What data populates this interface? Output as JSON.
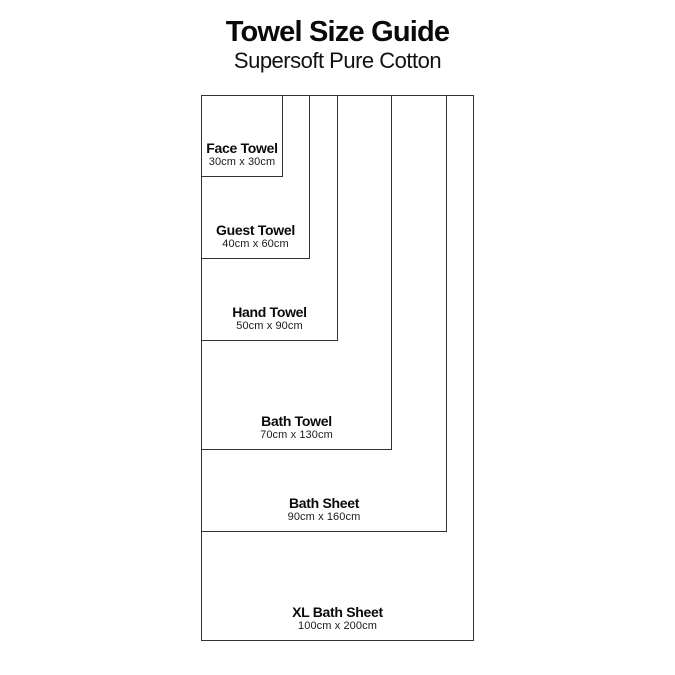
{
  "header": {
    "title": "Towel Size Guide",
    "subtitle": "Supersoft Pure Cotton"
  },
  "diagram": {
    "unit": "cm",
    "line_color": "#333333",
    "pixels_per_cm": 2.73,
    "towels": [
      {
        "name": "Face Towel",
        "dims_label": "30cm x 30cm",
        "width_cm": 30,
        "height_cm": 30
      },
      {
        "name": "Guest Towel",
        "dims_label": "40cm x 60cm",
        "width_cm": 40,
        "height_cm": 60
      },
      {
        "name": "Hand Towel",
        "dims_label": "50cm x 90cm",
        "width_cm": 50,
        "height_cm": 90
      },
      {
        "name": "Bath Towel",
        "dims_label": "70cm x 130cm",
        "width_cm": 70,
        "height_cm": 130
      },
      {
        "name": "Bath Sheet",
        "dims_label": "90cm x 160cm",
        "width_cm": 90,
        "height_cm": 160
      },
      {
        "name": "XL Bath Sheet",
        "dims_label": "100cm x 200cm",
        "width_cm": 100,
        "height_cm": 200
      }
    ]
  }
}
